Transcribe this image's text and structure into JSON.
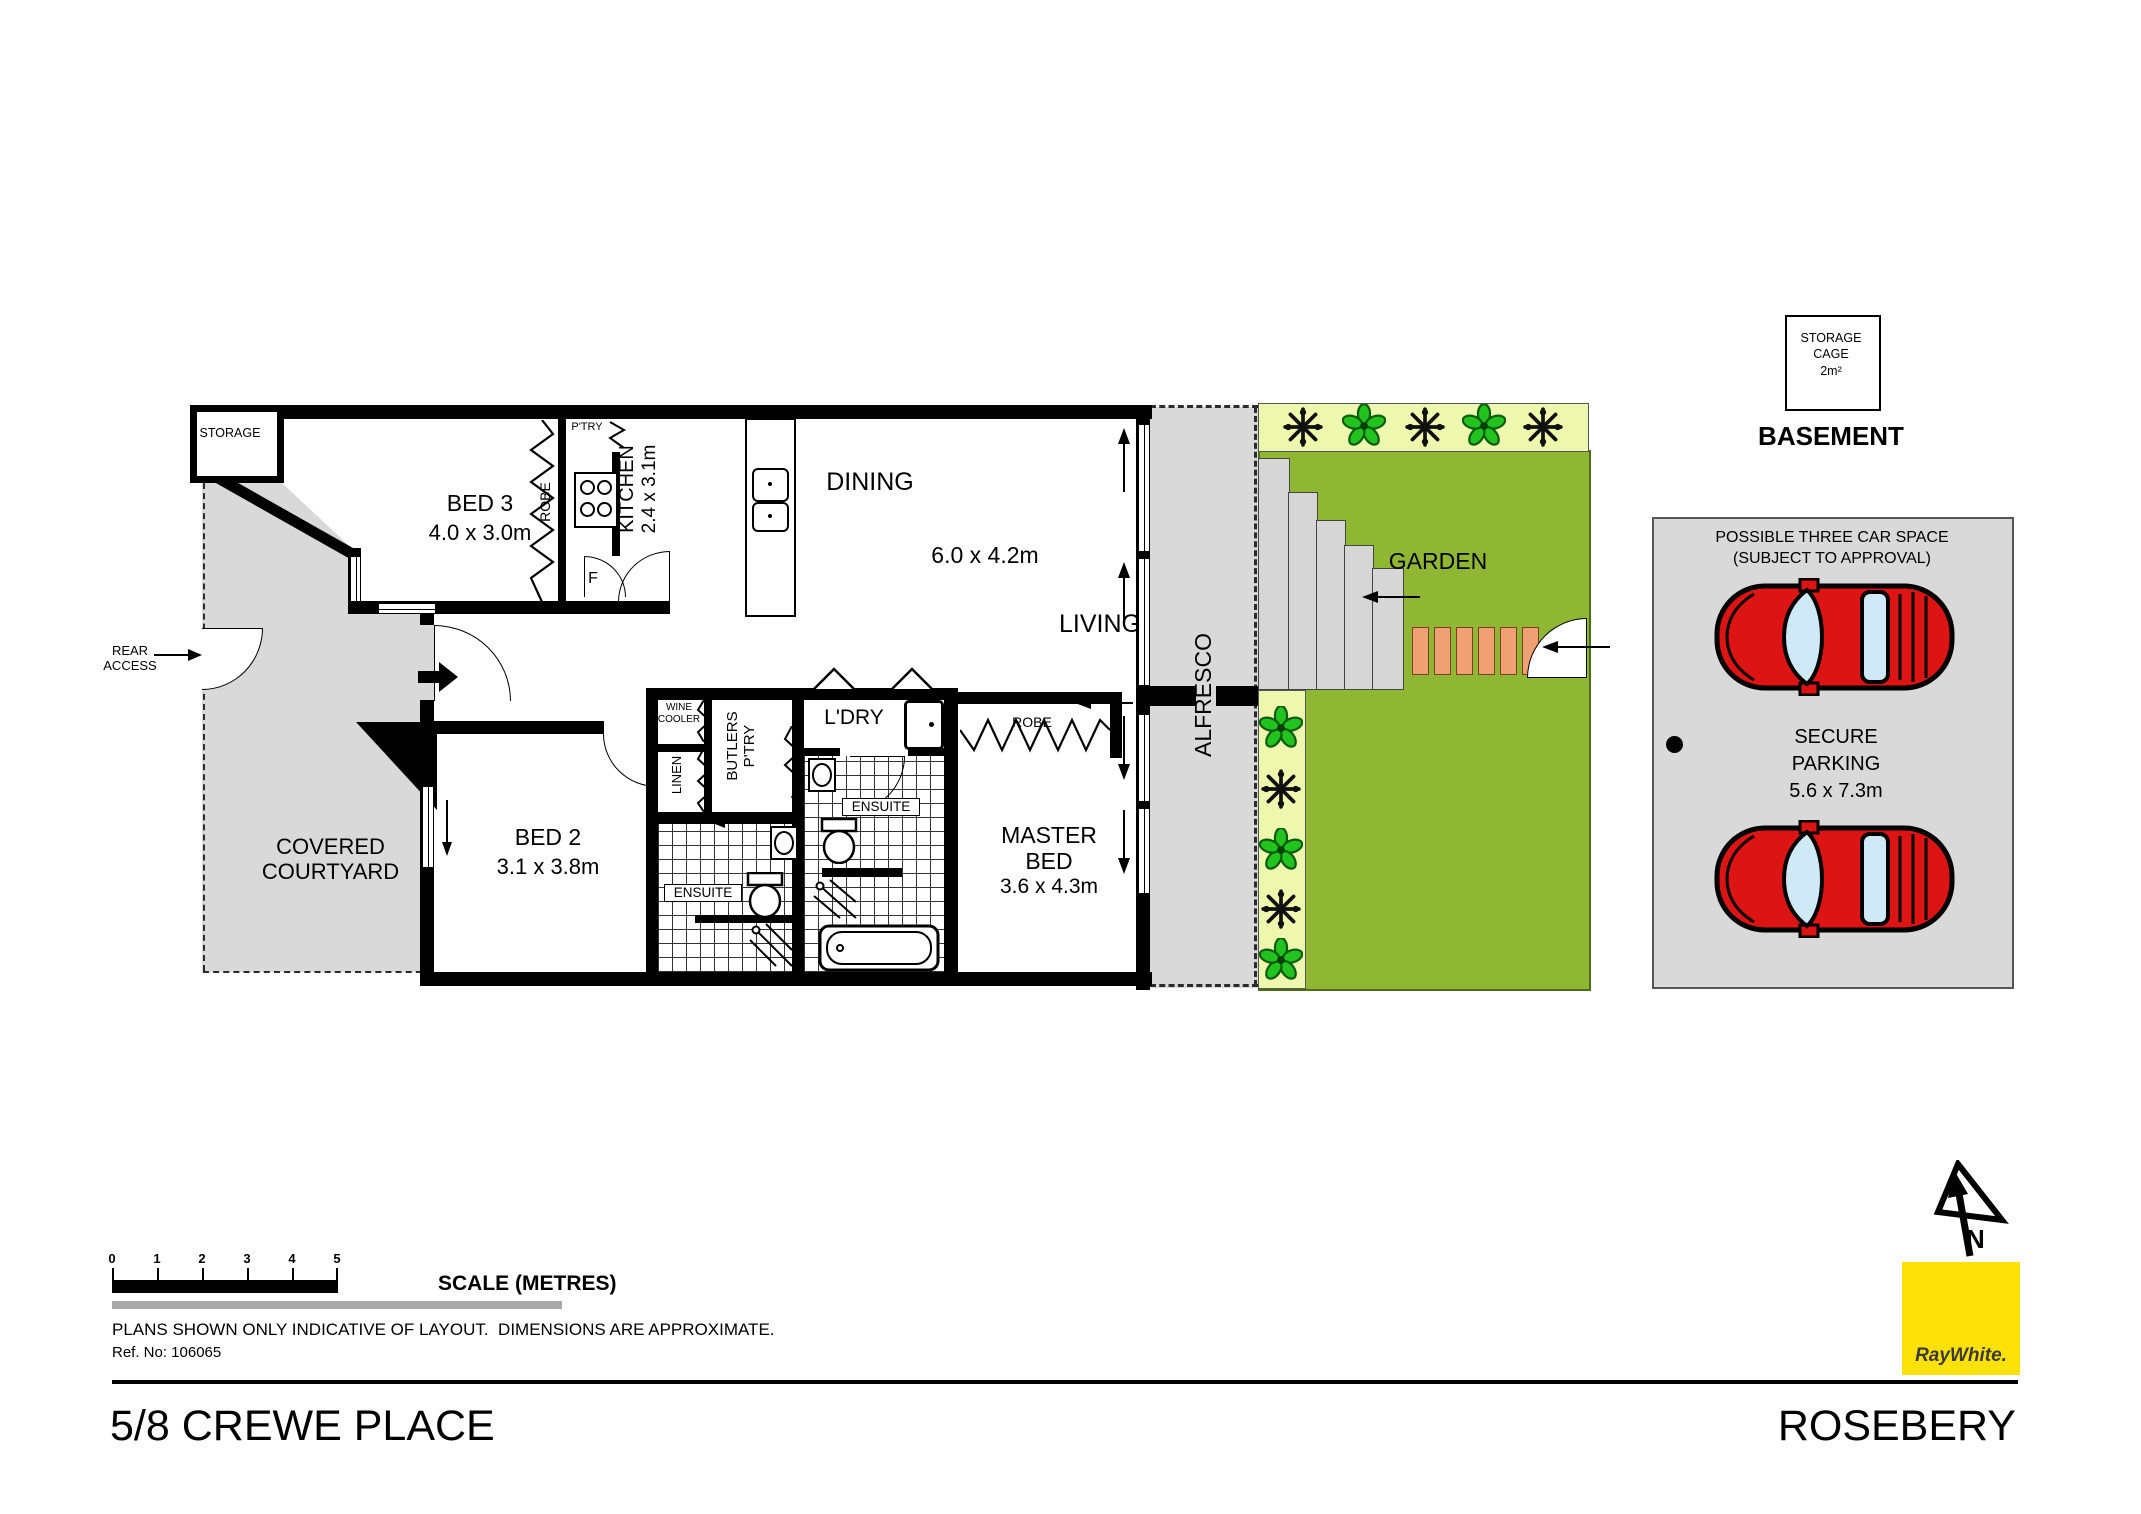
{
  "plan": {
    "storage": "STORAGE",
    "bed3": "BED 3",
    "bed3_dims": "4.0 x 3.0m",
    "robe_bed3": "ROBE",
    "pantry": "P'TRY",
    "kitchen": "KITCHEN",
    "kitchen_dims": "2.4 x 3.1m",
    "fridge": "F",
    "dining": "DINING",
    "living_dims": "6.0 x 4.2m",
    "living": "LIVING",
    "alfresco": "ALFRESCO",
    "garden": "GARDEN",
    "rear_1": "REAR",
    "rear_2": "ACCESS",
    "courtyard_1": "COVERED",
    "courtyard_2": "COURTYARD",
    "bed2": "BED 2",
    "bed2_dims": "3.1 x 3.8m",
    "wine_1": "WINE",
    "wine_2": "COOLER",
    "linen": "LINEN",
    "butlers_1": "BUTLERS",
    "butlers_2": "P'TRY",
    "ldry": "L'DRY",
    "ensuite_bed2": "ENSUITE",
    "ensuite_master": "ENSUITE",
    "robe_master": "ROBE",
    "master_1": "MASTER",
    "master_2": "BED",
    "master_dims": "3.6 x 4.3m"
  },
  "basement": {
    "cage_1": "STORAGE",
    "cage_2": "CAGE",
    "cage_3": "2m²",
    "title": "BASEMENT",
    "note_1": "POSSIBLE THREE CAR SPACE",
    "note_2": "(SUBJECT TO APPROVAL)",
    "secure_1": "SECURE",
    "secure_2": "PARKING",
    "secure_dims": "5.6 x 7.3m"
  },
  "scale_bar": {
    "ticks": [
      "0",
      "1",
      "2",
      "3",
      "4",
      "5"
    ],
    "label": "SCALE (METRES)"
  },
  "footer": {
    "disclaimer": "PLANS SHOWN ONLY INDICATIVE OF LAYOUT.  DIMENSIONS ARE APPROXIMATE.",
    "ref": "Ref. No: 106065",
    "address": "5/8 CREWE PLACE",
    "suburb": "ROSEBERY"
  },
  "compass": {
    "north": "N"
  },
  "logo": {
    "text": "RayWhite."
  },
  "colors": {
    "garden_green": "#8fb733",
    "planter_bg": "#eef7ae",
    "paver_orange": "#f0a173",
    "car_red": "#dd1414",
    "surface_grey": "#d9d9d9",
    "logo_yellow": "#ffe10a"
  }
}
